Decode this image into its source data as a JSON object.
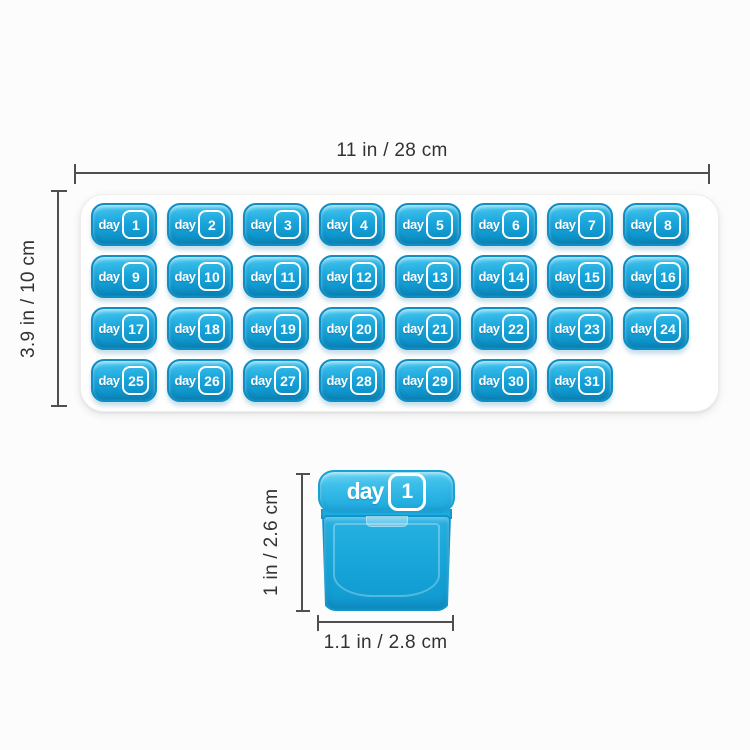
{
  "figure": {
    "tray": {
      "width_dim_label": "11 in / 28 cm",
      "height_dim_label": "3.9 in / 10 cm",
      "day_label": "day",
      "days": [
        "1",
        "2",
        "3",
        "4",
        "5",
        "6",
        "7",
        "8",
        "9",
        "10",
        "11",
        "12",
        "13",
        "14",
        "15",
        "16",
        "17",
        "18",
        "19",
        "20",
        "21",
        "22",
        "23",
        "24",
        "25",
        "26",
        "27",
        "28",
        "29",
        "30",
        "31"
      ]
    },
    "single_pod": {
      "day_label": "day",
      "day_number": "1",
      "height_dim_label": "1 in / 2.6 cm",
      "width_dim_label": "1.1 in / 2.8 cm"
    },
    "colors": {
      "pod_blue": "#18a4da",
      "pod_blue_light": "#6fd4f2",
      "pod_blue_dark": "#0d8ec5",
      "dimension_line": "#4f4f4f",
      "label_text": "#333333",
      "tray_white": "#ffffff"
    }
  }
}
